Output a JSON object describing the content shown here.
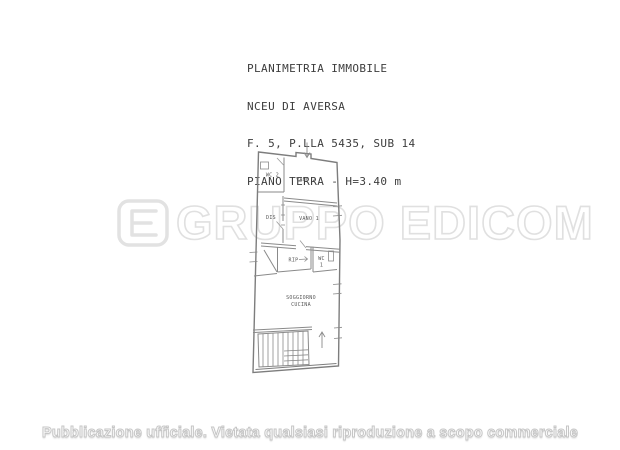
{
  "document": {
    "title_block": {
      "lines": [
        "PLANIMETRIA IMMOBILE",
        "NCEU DI AVERSA",
        "F. 5, P.LLA 5435, SUB 14",
        "PIANO TERRA - H=3.40 m"
      ]
    },
    "watermark": {
      "text": "GRUPPO EDICOM",
      "logo": "edicom-e-logo",
      "color": "#e0e0e0"
    },
    "floor_plan": {
      "line_color": "#7d7d7d",
      "rooms": [
        {
          "id": "wc-2",
          "label": "WC 2"
        },
        {
          "id": "vano-2",
          "label": "VANO 2"
        },
        {
          "id": "dis",
          "label": "DIS"
        },
        {
          "id": "vano-1",
          "label": "VANO 1"
        },
        {
          "id": "rip",
          "label": "RIP"
        },
        {
          "id": "wc-1",
          "label_line1": "WC",
          "label_line2": "1"
        },
        {
          "id": "soggiorno-cucina",
          "label_line1": "SOGGIORNO",
          "label_line2": "CUCINA"
        }
      ],
      "features": [
        "entrance-arrow",
        "staircase",
        "stairs-up-arrow",
        "window-marks"
      ]
    },
    "footer": {
      "notice": "Pubblicazione ufficiale. Vietata qualsiasi riproduzione a scopo commerciale"
    }
  }
}
